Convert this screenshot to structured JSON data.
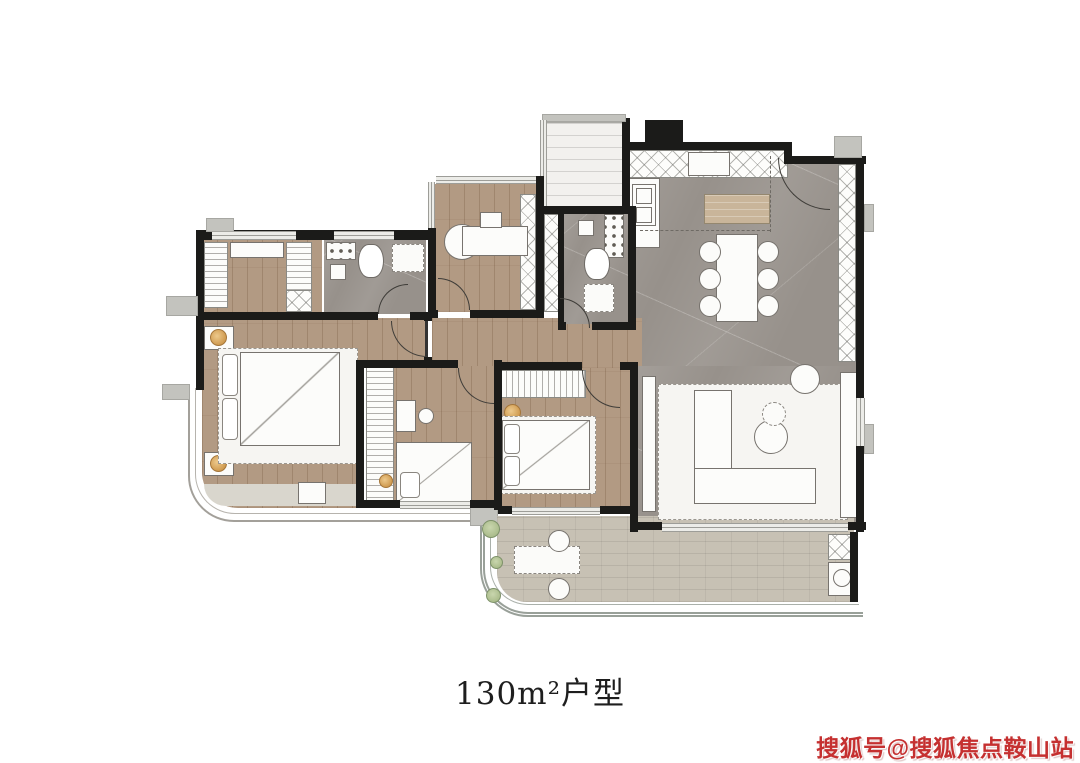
{
  "caption": {
    "text": "130m²户型"
  },
  "watermark": {
    "text": "搜狐号@搜狐焦点鞍山站",
    "color": "#c53030"
  },
  "colors": {
    "wall": "#1b1b19",
    "wood_floor": "#b29a83",
    "marble_floor": "#97918b",
    "balcony_tile": "#c7c1b4",
    "lamp_accent": "#cf9a4f",
    "plant": "#9fb27e",
    "watermark_red": "#c53030"
  }
}
